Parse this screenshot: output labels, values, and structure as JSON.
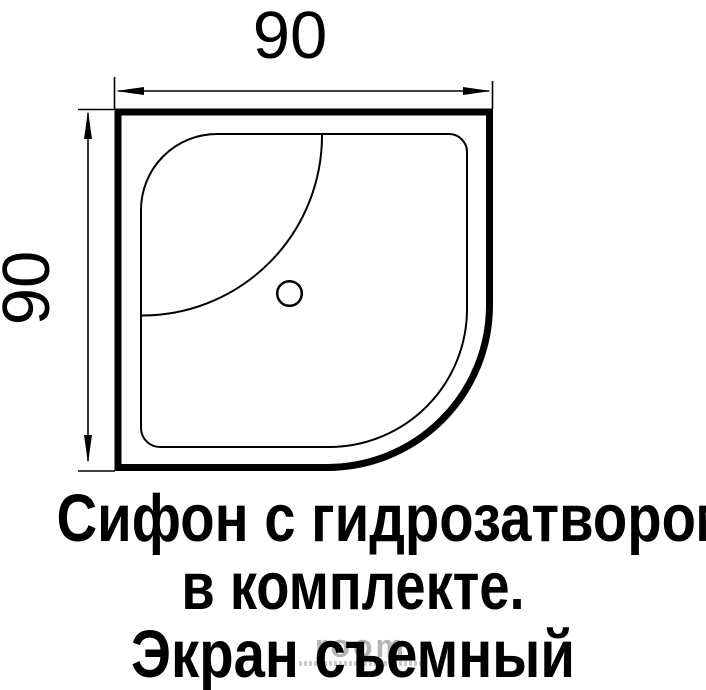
{
  "figure": {
    "type": "shower-tray-plan-drawing",
    "view": "top view, quarter-round corner tray"
  },
  "dimensions": {
    "top": {
      "label": "90"
    },
    "left": {
      "label": "90"
    }
  },
  "caption": {
    "lines": [
      "Сифон с гидрозатвором",
      "в комплекте.",
      "Экран съемный"
    ]
  },
  "watermark": {
    "text": "room"
  },
  "colors": {
    "line": "#000000",
    "background": "#ffffff",
    "watermark_gray": "#b5b5b5"
  }
}
